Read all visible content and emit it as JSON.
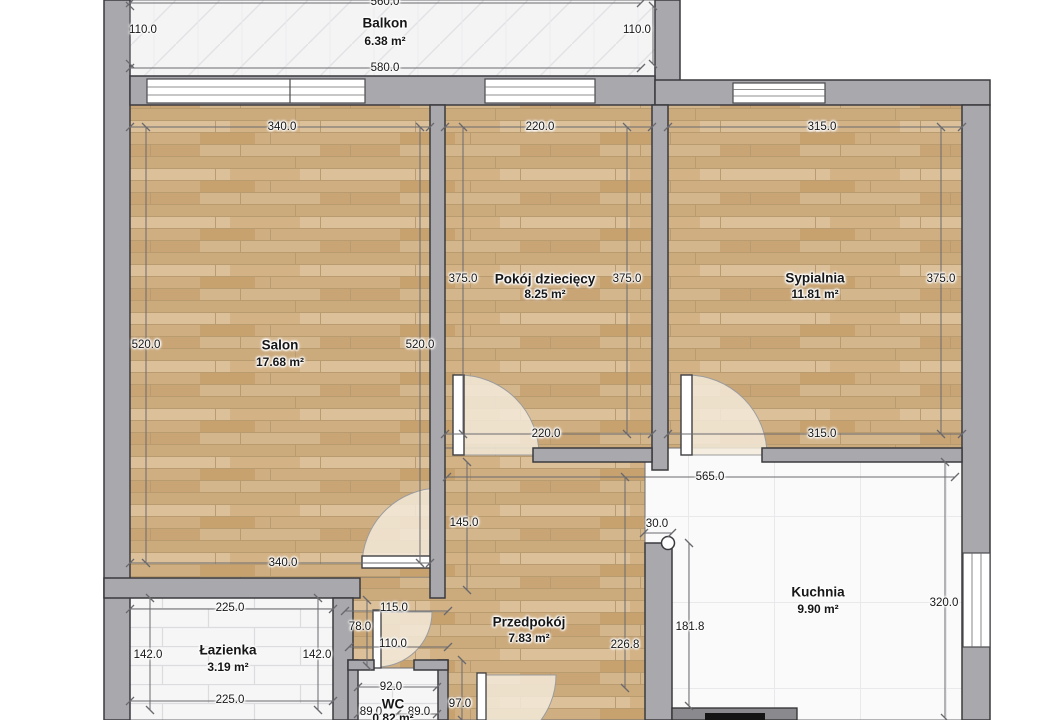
{
  "plan": {
    "title": "Rzut mieszkania",
    "rooms": [
      {
        "name": "Balkon",
        "area": "6.38 m²",
        "x": 385,
        "ny": 23,
        "ay": 41
      },
      {
        "name": "Salon",
        "area": "17.68 m²",
        "x": 280,
        "ny": 345,
        "ay": 362
      },
      {
        "name": "Pokój dziecięcy",
        "area": "8.25 m²",
        "x": 545,
        "ny": 279,
        "ay": 294
      },
      {
        "name": "Sypialnia",
        "area": "11.81 m²",
        "x": 815,
        "ny": 278,
        "ay": 294
      },
      {
        "name": "Kuchnia",
        "area": "9.90 m²",
        "x": 818,
        "ny": 592,
        "ay": 609
      },
      {
        "name": "Przedpokój",
        "area": "7.83 m²",
        "x": 529,
        "ny": 622,
        "ay": 638
      },
      {
        "name": "Łazienka",
        "area": "3.19 m²",
        "x": 228,
        "ny": 650,
        "ay": 667
      },
      {
        "name": "WC",
        "area": "0.82 m²",
        "x": 393,
        "ny": 704,
        "ay": 718
      }
    ],
    "dimensions": [
      {
        "label": "560.0",
        "x": 385,
        "y": 2,
        "x1": 130,
        "y1": 3,
        "x2": 641,
        "y2": 3
      },
      {
        "label": "110.0",
        "x": 143,
        "y": 30,
        "x1": 130,
        "y1": 6,
        "x2": 130,
        "y2": 64
      },
      {
        "label": "110.0",
        "x": 637,
        "y": 30,
        "x1": 653,
        "y1": 6,
        "x2": 653,
        "y2": 64
      },
      {
        "label": "580.0",
        "x": 385,
        "y": 68,
        "x1": 130,
        "y1": 68,
        "x2": 641,
        "y2": 68
      },
      {
        "label": "340.0",
        "x": 282,
        "y": 127,
        "x1": 130,
        "y1": 127,
        "x2": 430,
        "y2": 127
      },
      {
        "label": "220.0",
        "x": 540,
        "y": 127,
        "x1": 445,
        "y1": 127,
        "x2": 652,
        "y2": 127
      },
      {
        "label": "315.0",
        "x": 822,
        "y": 127,
        "x1": 668,
        "y1": 127,
        "x2": 962,
        "y2": 127
      },
      {
        "label": "520.0",
        "x": 146,
        "y": 345,
        "x1": 146,
        "y1": 127,
        "x2": 146,
        "y2": 563
      },
      {
        "label": "520.0",
        "x": 420,
        "y": 345,
        "x1": 420,
        "y1": 127,
        "x2": 420,
        "y2": 563
      },
      {
        "label": "375.0",
        "x": 463,
        "y": 279,
        "x1": 463,
        "y1": 127,
        "x2": 463,
        "y2": 434
      },
      {
        "label": "375.0",
        "x": 627,
        "y": 279,
        "x1": 627,
        "y1": 127,
        "x2": 627,
        "y2": 434
      },
      {
        "label": "375.0",
        "x": 941,
        "y": 279,
        "x1": 941,
        "y1": 127,
        "x2": 941,
        "y2": 434
      },
      {
        "label": "220.0",
        "x": 546,
        "y": 434,
        "x1": 445,
        "y1": 434,
        "x2": 652,
        "y2": 434
      },
      {
        "label": "315.0",
        "x": 822,
        "y": 434,
        "x1": 668,
        "y1": 434,
        "x2": 962,
        "y2": 434
      },
      {
        "label": "340.0",
        "x": 283,
        "y": 563,
        "x1": 130,
        "y1": 563,
        "x2": 430,
        "y2": 563
      },
      {
        "label": "145.0",
        "x": 464,
        "y": 523,
        "x1": 467,
        "y1": 462,
        "x2": 467,
        "y2": 590
      },
      {
        "label": "565.0",
        "x": 710,
        "y": 477,
        "x1": 447,
        "y1": 477,
        "x2": 955,
        "y2": 477
      },
      {
        "label": "30.0",
        "x": 657,
        "y": 524,
        "x1": 644,
        "y1": 533,
        "x2": 672,
        "y2": 533
      },
      {
        "label": "181.8",
        "x": 690,
        "y": 627,
        "x1": 689,
        "y1": 543,
        "x2": 689,
        "y2": 706
      },
      {
        "label": "226.8",
        "x": 625,
        "y": 645,
        "x1": 625,
        "y1": 477,
        "x2": 625,
        "y2": 688
      },
      {
        "label": "320.0",
        "x": 944,
        "y": 603,
        "x1": 945,
        "y1": 462,
        "x2": 945,
        "y2": 718
      },
      {
        "label": "225.0",
        "x": 230,
        "y": 608,
        "x1": 130,
        "y1": 609,
        "x2": 333,
        "y2": 609
      },
      {
        "label": "142.0",
        "x": 148,
        "y": 655,
        "x1": 150,
        "y1": 598,
        "x2": 150,
        "y2": 710
      },
      {
        "label": "142.0",
        "x": 317,
        "y": 655,
        "x1": 318,
        "y1": 598,
        "x2": 318,
        "y2": 710
      },
      {
        "label": "225.0",
        "x": 230,
        "y": 700,
        "x1": 130,
        "y1": 701,
        "x2": 333,
        "y2": 701
      },
      {
        "label": "115.0",
        "x": 394,
        "y": 608,
        "x1": 345,
        "y1": 611,
        "x2": 448,
        "y2": 611
      },
      {
        "label": "78.0",
        "x": 360,
        "y": 627,
        "x1": 367,
        "y1": 600,
        "x2": 367,
        "y2": 666
      },
      {
        "label": "110.0",
        "x": 393,
        "y": 644,
        "x1": 349,
        "y1": 647,
        "x2": 448,
        "y2": 647
      },
      {
        "label": "92.0",
        "x": 391,
        "y": 687,
        "x1": 358,
        "y1": 687,
        "x2": 437,
        "y2": 687
      },
      {
        "label": "89.0",
        "x": 371,
        "y": 712,
        "x1": 358,
        "y1": 714,
        "x2": 397,
        "y2": 714
      },
      {
        "label": "89.0",
        "x": 419,
        "y": 712,
        "x1": 397,
        "y1": 714,
        "x2": 437,
        "y2": 714
      },
      {
        "label": "97.0",
        "x": 460,
        "y": 704,
        "x1": 462,
        "y1": 660,
        "x2": 462,
        "y2": 720
      }
    ],
    "colors": {
      "background": "#ffffff",
      "wall_fill": "#a9a9ad",
      "wall_outline": "#3a3a3e",
      "wood_floor": "#d2b286",
      "tile_floor": "#f6f6f7",
      "dimension_line": "#6a6a6e",
      "dimension_text": "#161616"
    }
  }
}
